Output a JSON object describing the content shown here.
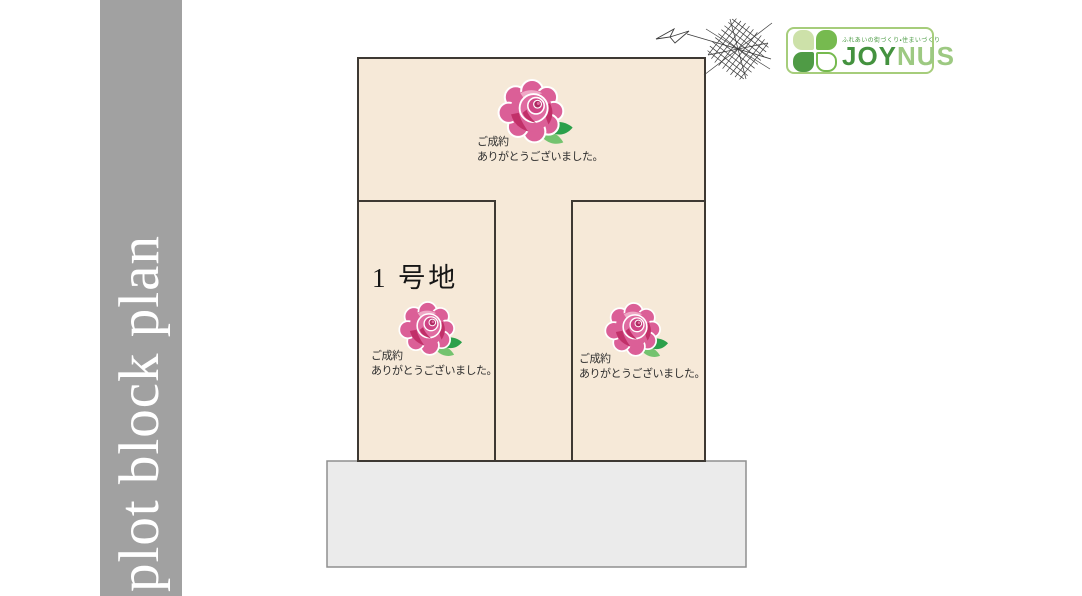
{
  "sidebar": {
    "title": "plot block plan"
  },
  "plan": {
    "plots": [
      {
        "id": "rear-plot",
        "sold_line1": "ご成約",
        "sold_line2": "ありがとうございました。"
      },
      {
        "id": "plot-1",
        "label": "1 号地",
        "sold_line1": "ご成約",
        "sold_line2": "ありがとうございました。"
      },
      {
        "id": "right-plot",
        "sold_line1": "ご成約",
        "sold_line2": "ありがとうございました。"
      }
    ]
  },
  "logo": {
    "joy": "JOY",
    "nus": "NUS",
    "tagline": "ふれあいの街づくり・住まいづくり"
  },
  "colors": {
    "parcel_fill": "#f6e9d8",
    "parcel_border": "#3e3933",
    "road_fill": "#ebebeb",
    "sidebar_gray": "#a1a1a1",
    "rose_pink": "#db5f97",
    "rose_dark_pink": "#c13069",
    "leaf_green": "#2ca04b",
    "brand_green_dark": "#44923f",
    "brand_green_light": "#9dc982"
  }
}
